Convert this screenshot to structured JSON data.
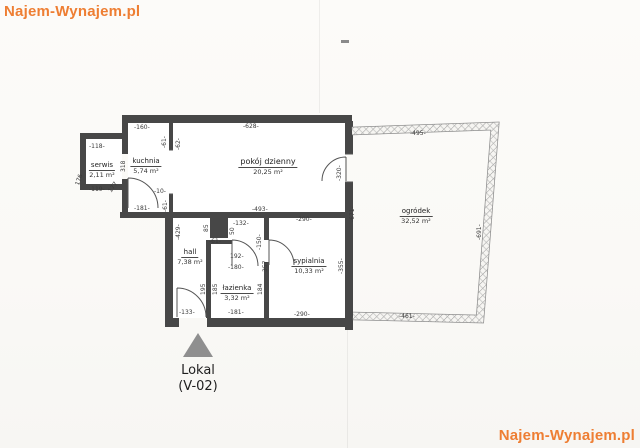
{
  "watermark": {
    "text": "Najem-Wynajem.pl"
  },
  "rooms": [
    {
      "name": "serwis",
      "area": "2,11 m²"
    },
    {
      "name": "kuchnia",
      "area": "5,74 m²"
    },
    {
      "name": "pokój dzienny",
      "area": "20,25 m²"
    },
    {
      "name": "hall",
      "area": "7,38 m²"
    },
    {
      "name": "łazienka",
      "area": "3,32 m²"
    },
    {
      "name": "sypialnia",
      "area": "10,33 m²"
    },
    {
      "name": "ogródek",
      "area": "32,52 m²"
    }
  ],
  "dims": [
    "-118-",
    "-119-",
    "176",
    "177",
    "318",
    "-160-",
    "-61-",
    "-62-",
    "-10-",
    "-61-",
    "-181-",
    "-628-",
    "-493-",
    "-320-",
    "-495-",
    "-691-",
    "-461-",
    "-671-",
    "-429-",
    "85",
    "50",
    "-61-",
    "-132-",
    "-150-",
    "192-",
    "-180-",
    "-355-",
    "357",
    "184",
    "195",
    "185",
    "-133-",
    "-181-",
    "-290-",
    "-290-"
  ],
  "marker": {
    "line1": "Lokal",
    "line2": "(V-02)"
  },
  "colors": {
    "wall": "#474747",
    "watermark_orange": "#ee7e33",
    "triangle_gray": "#8f8f8f",
    "fence_hatch": "#9a9a9a"
  }
}
